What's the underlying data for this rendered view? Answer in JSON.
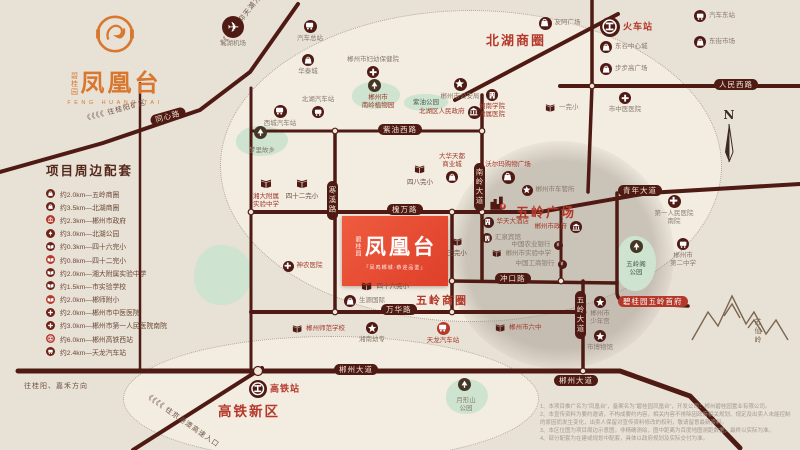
{
  "logo": {
    "brand": "碧桂园",
    "name": "凤凰台",
    "tagline": "FENG HUANG TAI"
  },
  "amenities": {
    "title": "项目周边配套",
    "items": [
      {
        "icon": "mall",
        "text": "约2.0km—五岭商圈"
      },
      {
        "icon": "mall",
        "text": "约3.5km—北湖商圈"
      },
      {
        "icon": "gov",
        "text": "约2.3km—郴州市政府"
      },
      {
        "icon": "tree",
        "text": "约3.0km—北湖公园"
      },
      {
        "icon": "bookw",
        "text": "约0.3km—四十六完小"
      },
      {
        "icon": "bookw",
        "text": "约0.8km—四十二完小"
      },
      {
        "icon": "bookw",
        "text": "约2.0km—湘大附属实验中学"
      },
      {
        "icon": "bookw",
        "text": "约1.5km—市实验学校"
      },
      {
        "icon": "bookw",
        "text": "约2.0km—郴师附小"
      },
      {
        "icon": "cross",
        "text": "约2.0km—郴州市中医医院"
      },
      {
        "icon": "cross",
        "text": "约3.0km—郴州市第一人民医院南院"
      },
      {
        "icon": "rail",
        "text": "约6.0km—郴州高铁西站"
      },
      {
        "icon": "bus",
        "text": "约2.4km—天龙汽车站"
      }
    ]
  },
  "project": {
    "brand": "碧桂园",
    "name": "凤凰台",
    "slogan": "「凤鸣郴城·恭迎品鉴」"
  },
  "compass_label": "N",
  "map": {
    "districts": [
      {
        "text": "北湖商圈",
        "x": 486,
        "y": 30,
        "size": 13
      },
      {
        "text": "五岭广场",
        "x": 516,
        "y": 202,
        "size": 13
      },
      {
        "text": "五岭商圈",
        "x": 416,
        "y": 292,
        "size": 11
      },
      {
        "text": "高铁新区",
        "x": 218,
        "y": 400,
        "size": 13.5
      }
    ],
    "road_badges": [
      {
        "label": "同心路",
        "x": 150,
        "y": 111,
        "rot": -16
      },
      {
        "label": "紫油西路",
        "x": 378,
        "y": 124
      },
      {
        "label": "槐万路",
        "x": 387,
        "y": 204
      },
      {
        "label": "南岭大道",
        "x": 474,
        "y": 163,
        "vert": true
      },
      {
        "label": "寒溪路",
        "x": 327,
        "y": 181,
        "vert": true
      },
      {
        "label": "万华路",
        "x": 381,
        "y": 304
      },
      {
        "label": "冲口路",
        "x": 495,
        "y": 273
      },
      {
        "label": "郴州大道",
        "x": 334,
        "y": 364
      },
      {
        "label": "郴州大道",
        "x": 554,
        "y": 375
      },
      {
        "label": "五岭大道",
        "x": 575,
        "y": 291,
        "vert": true
      },
      {
        "label": "青年大道",
        "x": 618,
        "y": 185
      },
      {
        "label": "人民西路",
        "x": 714,
        "y": 79
      },
      {
        "label": "碧桂园五岭首府",
        "x": 618,
        "y": 296,
        "red": true
      }
    ],
    "directions": [
      {
        "text": "《《《《 往桂阳矿区",
        "x": 84,
        "y": 114,
        "rot": -15
      },
      {
        "text": "《《《《 往仰天湖方向",
        "x": 220,
        "y": 42,
        "rot": -52
      },
      {
        "text": "《《《《 往京港澳高速入口",
        "x": 146,
        "y": 390,
        "rot": 35
      },
      {
        "text": "往桂阳、嘉禾方向",
        "x": 24,
        "y": 381,
        "rot": 0
      }
    ],
    "parks": [
      {
        "lines": [
          "郴州市",
          "南岭植物园"
        ],
        "x": 352,
        "y": 82,
        "w": 48,
        "h": 27,
        "tree": [
          374,
          85
        ],
        "lx": 378,
        "ly": 94,
        "lc": "red"
      },
      {
        "lines": [
          "紫油公园"
        ],
        "x": 404,
        "y": 94,
        "w": 44,
        "h": 17,
        "lx": 426,
        "ly": 99,
        "lc": "green"
      },
      {
        "lines": [
          "梦里故乡"
        ],
        "x": 236,
        "y": 126,
        "w": 52,
        "h": 30,
        "tree": [
          260,
          132
        ],
        "lx": 262,
        "ly": 147,
        "lc": "gray"
      },
      {
        "lines": [
          "五岭阁",
          "公园"
        ],
        "x": 616,
        "y": 236,
        "w": 40,
        "h": 55,
        "tree": [
          636,
          246
        ],
        "lx": 636,
        "ly": 261,
        "lc": "green"
      },
      {
        "lines": [
          "月形山",
          "公园"
        ],
        "x": 446,
        "y": 379,
        "w": 42,
        "h": 35,
        "tree": [
          464,
          384
        ],
        "lx": 466,
        "ly": 397,
        "lc": "gray"
      },
      {
        "lines": [],
        "x": 194,
        "y": 245,
        "w": 58,
        "h": 60,
        "lx": 0,
        "ly": 0,
        "lc": "gray"
      }
    ],
    "pois": [
      {
        "icon": "plane",
        "x": 233,
        "y": 27,
        "sz": 22,
        "label": [
          "北湖机场"
        ],
        "lp": "b",
        "lc": "gray"
      },
      {
        "icon": "bus",
        "x": 310,
        "y": 26,
        "sz": 13,
        "label": [
          "汽车总站"
        ],
        "lp": "b",
        "lc": "gray"
      },
      {
        "icon": "mall",
        "x": 308,
        "y": 60,
        "sz": 12,
        "label": [
          "华泰城"
        ],
        "lp": "b",
        "lc": "gray"
      },
      {
        "icon": "cross",
        "x": 373,
        "y": 72,
        "sz": 12,
        "label": [
          "郴州市妇幼保健院"
        ],
        "lp": "t",
        "lc": "gray"
      },
      {
        "icon": "bus",
        "x": 280,
        "y": 111,
        "sz": 13,
        "label": [
          "西城汽车站"
        ],
        "lp": "b",
        "lc": "gray"
      },
      {
        "icon": "bus",
        "x": 318,
        "y": 112,
        "sz": 12,
        "label": [
          "北湖汽车站"
        ],
        "lp": "t",
        "lc": "gray"
      },
      {
        "icon": "book",
        "x": 302,
        "y": 184,
        "sz": 14,
        "label": [
          "四十二完小"
        ],
        "lp": "b",
        "lc": "brown"
      },
      {
        "icon": "book",
        "x": 266,
        "y": 184,
        "sz": 14,
        "label": [
          "湘大附属",
          "实验中学"
        ],
        "lp": "b",
        "lc": "red"
      },
      {
        "icon": "star",
        "x": 460,
        "y": 84,
        "sz": 13,
        "label": [
          "郴州市公安局"
        ],
        "lp": "b",
        "lc": "gray"
      },
      {
        "icon": "hotel",
        "x": 492,
        "y": 95,
        "sz": 12,
        "label": [
          "湘南学院",
          "附属医院"
        ],
        "lp": "b",
        "lc": "red"
      },
      {
        "icon": "mall",
        "x": 545,
        "y": 23,
        "sz": 13,
        "label": [
          "友阿广场"
        ],
        "lp": "r",
        "lc": "gray"
      },
      {
        "icon": "rail",
        "x": 610,
        "y": 27,
        "sz": 20,
        "label": [
          "火车站"
        ],
        "lp": "r",
        "lc": "redbold"
      },
      {
        "icon": "mall",
        "x": 606,
        "y": 47,
        "sz": 12,
        "label": [
          "东谷中心城"
        ],
        "lp": "r",
        "lc": "gray"
      },
      {
        "icon": "mall",
        "x": 606,
        "y": 69,
        "sz": 12,
        "label": [
          "步步高广场"
        ],
        "lp": "r",
        "lc": "gray"
      },
      {
        "icon": "bus",
        "x": 700,
        "y": 16,
        "sz": 12,
        "label": [
          "汽车东站"
        ],
        "lp": "r",
        "lc": "gray"
      },
      {
        "icon": "mall",
        "x": 700,
        "y": 42,
        "sz": 12,
        "label": [
          "东街市场"
        ],
        "lp": "r",
        "lc": "gray"
      },
      {
        "icon": "book",
        "x": 550,
        "y": 108,
        "sz": 12,
        "label": [
          "一完小"
        ],
        "lp": "r",
        "lc": "gray"
      },
      {
        "icon": "cross",
        "x": 625,
        "y": 98,
        "sz": 12,
        "label": [
          "市中医医院"
        ],
        "lp": "b",
        "lc": "gray"
      },
      {
        "icon": "gov",
        "x": 474,
        "y": 112,
        "sz": 13,
        "label": [
          "北湖区人民政府"
        ],
        "lp": "l",
        "lc": "red"
      },
      {
        "icon": "mall",
        "x": 508,
        "y": 177,
        "sz": 13,
        "label": [
          "沃尔玛购物广场"
        ],
        "lp": "t",
        "lc": "red"
      },
      {
        "icon": "star",
        "x": 527,
        "y": 190,
        "sz": 11,
        "label": [
          "郴州市车管所"
        ],
        "lp": "r",
        "lc": "gray"
      },
      {
        "icon": "mall",
        "x": 452,
        "y": 177,
        "sz": 12,
        "label": [
          "大华天都",
          "商业城"
        ],
        "lp": "t",
        "lc": "red"
      },
      {
        "icon": "book",
        "x": 420,
        "y": 170,
        "sz": 13,
        "label": [
          "四八完小"
        ],
        "lp": "b",
        "lc": "brown"
      },
      {
        "icon": "city",
        "x": 498,
        "y": 203,
        "sz": 20,
        "label": [],
        "lp": "b",
        "lc": "gray"
      },
      {
        "icon": "hotel",
        "x": 488,
        "y": 222,
        "sz": 11,
        "label": [
          "华天大酒店"
        ],
        "lp": "r",
        "lc": "red"
      },
      {
        "icon": "gov",
        "x": 576,
        "y": 227,
        "sz": 12,
        "label": [
          "郴州市政府"
        ],
        "lp": "l",
        "lc": "red"
      },
      {
        "icon": "hotel",
        "x": 487,
        "y": 238,
        "sz": 10,
        "label": [
          "汇泉宾馆"
        ],
        "lp": "r",
        "lc": "gray"
      },
      {
        "icon": "bank",
        "x": 558,
        "y": 245,
        "sz": 9,
        "label": [
          "中国农业银行"
        ],
        "lp": "l",
        "lc": "gray"
      },
      {
        "icon": "book",
        "x": 497,
        "y": 254,
        "sz": 11,
        "label": [
          "郴州市实验中学"
        ],
        "lp": "r",
        "lc": "gray"
      },
      {
        "icon": "bank",
        "x": 562,
        "y": 264,
        "sz": 9,
        "label": [
          "中国工商银行"
        ],
        "lp": "l",
        "lc": "gray"
      },
      {
        "icon": "book",
        "x": 457,
        "y": 242,
        "sz": 12,
        "label": [
          "三完小"
        ],
        "lp": "b",
        "lc": "brown"
      },
      {
        "icon": "mall",
        "x": 350,
        "y": 301,
        "sz": 12,
        "label": [
          "生源国际"
        ],
        "lp": "r",
        "lc": "gray"
      },
      {
        "icon": "book",
        "x": 367,
        "y": 287,
        "sz": 13,
        "label": [
          "四十六完小"
        ],
        "lp": "r",
        "lc": "brown"
      },
      {
        "icon": "cross",
        "x": 288,
        "y": 266,
        "sz": 11,
        "label": [
          "神农医院"
        ],
        "lp": "r",
        "lc": "red"
      },
      {
        "icon": "book",
        "x": 297,
        "y": 329,
        "sz": 12,
        "label": [
          "郴州师范学校"
        ],
        "lp": "r",
        "lc": "red"
      },
      {
        "icon": "star",
        "x": 372,
        "y": 328,
        "sz": 12,
        "label": [
          "湘南幼专"
        ],
        "lp": "b",
        "lc": "gray"
      },
      {
        "icon": "bus",
        "x": 443,
        "y": 328,
        "sz": 13,
        "red": true,
        "label": [
          "天龙汽车站"
        ],
        "lp": "b",
        "lc": "red"
      },
      {
        "icon": "rail",
        "x": 258,
        "y": 389,
        "sz": 18,
        "label": [
          "高铁站"
        ],
        "lp": "r",
        "lc": "redbold"
      },
      {
        "icon": "bus",
        "x": 683,
        "y": 244,
        "sz": 12,
        "label": [
          "郴州市",
          "第二中学"
        ],
        "lp": "b",
        "lc": "gray"
      },
      {
        "icon": "cross",
        "x": 674,
        "y": 201,
        "sz": 13,
        "label": [
          "第一人民医院",
          "南院"
        ],
        "lp": "b",
        "lc": "gray"
      },
      {
        "icon": "star",
        "x": 600,
        "y": 302,
        "sz": 12,
        "label": [
          "郴州市",
          "少年宫"
        ],
        "lp": "b",
        "lc": "gray"
      },
      {
        "icon": "star",
        "x": 600,
        "y": 336,
        "sz": 12,
        "label": [
          "市博物馆"
        ],
        "lp": "b",
        "lc": "gray"
      },
      {
        "icon": "book",
        "x": 500,
        "y": 328,
        "sz": 12,
        "label": [
          "郴州市六中"
        ],
        "lp": "r",
        "lc": "red"
      }
    ],
    "mountain_label": "苏仙岭"
  },
  "disclaimer": {
    "lines": [
      "1、本项目推广名为“凤凰台”，备案名为“碧桂园凤凰台”，开发公司：郴州碧桂园置业有限公司。",
      "2、本宣传资料为要约邀请，不构成要约内容，相关内容不排除因政府相关规划、规定及出卖人未能控制的原因而发生变化，出卖人保留对宣传资料修改的权利，敬请留意最新资料。",
      "3、本区位图为项目周边示意图，非精确测绘，图中距离为百度地图测距数据，最终以实际为准。",
      "4、部分配套为在建或规划中配套，具体以政府规划及实际交付为准。"
    ]
  }
}
